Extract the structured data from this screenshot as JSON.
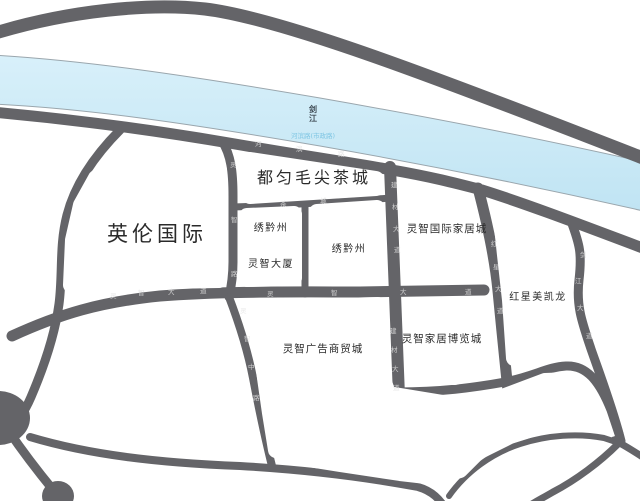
{
  "map": {
    "river": {
      "name_label": "剑江",
      "road_label": "河滨路(市政路)"
    },
    "places": [
      {
        "id": "yinglun-international",
        "label": "英伦国际"
      },
      {
        "id": "maojian-tea-city",
        "label": "都匀毛尖茶城"
      },
      {
        "id": "xiuqianzhou-west",
        "label": "绣黔州"
      },
      {
        "id": "lingzhi-tower",
        "label": "灵智大厦"
      },
      {
        "id": "xiuqianzhou-east",
        "label": "绣黔州"
      },
      {
        "id": "lingzhi-intl-home-city",
        "label": "灵智国际家居城"
      },
      {
        "id": "hongxing-meikailong",
        "label": "红星美凯龙"
      },
      {
        "id": "lingzhi-ad-trade-city",
        "label": "灵智广告商贸城"
      },
      {
        "id": "lingzhi-home-expo-city",
        "label": "灵智家居博览城"
      }
    ],
    "road_labels": [
      {
        "id": "lingzhi-road",
        "label": "灵智路"
      },
      {
        "id": "hebin-road",
        "label": "河滨路"
      },
      {
        "id": "chacheng-road",
        "label": "茶城"
      },
      {
        "id": "jiancai-avenue-north",
        "label": "建材大道"
      },
      {
        "id": "jiancai-avenue-south",
        "label": "建材大道"
      },
      {
        "id": "hongxing-avenue",
        "label": "红星大道"
      },
      {
        "id": "lingzhi-avenue-west",
        "label": "灵智大道"
      },
      {
        "id": "lingzhi-avenue-east",
        "label": "灵智大道"
      },
      {
        "id": "lingzhi-middle-road",
        "label": "灵智中路"
      },
      {
        "id": "jianjiang-avenue",
        "label": "剑江大道"
      }
    ],
    "colors": {
      "background": "#ffffff",
      "road": "#646468",
      "river": "#cbe9f7",
      "river_stroke": "#9aa6ad",
      "place_label": "#2a2a2a",
      "road_label": "#e3e3e3",
      "river_road_label": "#7fc6e3",
      "river_name": "#3f4b55"
    }
  }
}
